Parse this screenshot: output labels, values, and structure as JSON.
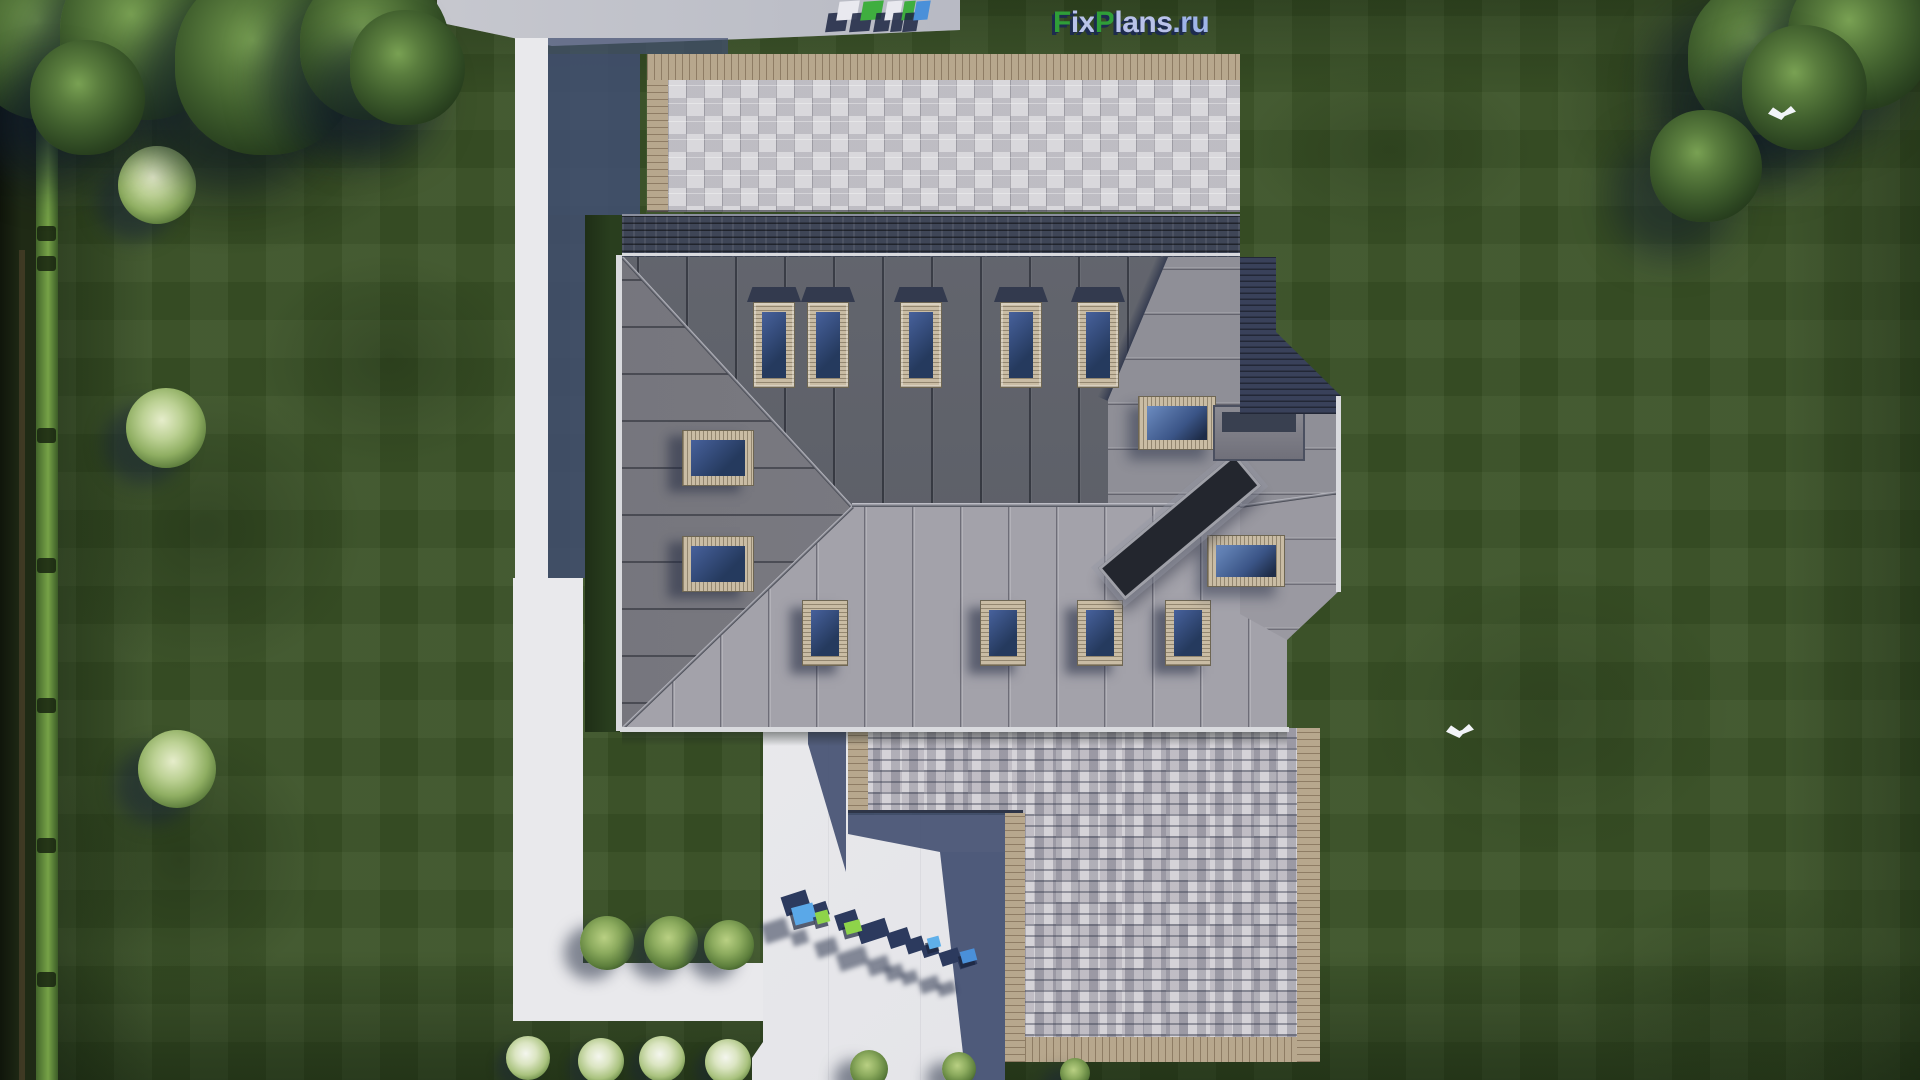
{
  "watermark": {
    "site_logo": {
      "f": "F",
      "ix": "ix",
      "p": "P",
      "lans": "lans",
      "ru": ".ru",
      "full_text": "FixPlans.ru"
    },
    "pavement_text": "FixPlans.ru"
  },
  "scene": {
    "type": "aerial top-down 3D render of house plan",
    "house": {
      "main_roof": "standing-seam metal hip roof",
      "skylight_count_north": 5,
      "skylight_count_south": 4,
      "skylight_count_west": 2,
      "skylight_count_east": 2,
      "features": [
        "paved patio wing (top)",
        "shingled garage wing (bottom)",
        "roof channel with chimney",
        "white driveway",
        "L-shaped walkway"
      ]
    },
    "environment": [
      "lawn with mowing stripes",
      "hedge and fence on left",
      "tree clusters top-left and top-right",
      "light green bushes",
      "white flower bushes",
      "two white birds"
    ]
  },
  "palette": {
    "lawn": "#3a5226",
    "roof_north": "#5d6069",
    "roof_south": "#a3a2aa",
    "roof_west": "#7e7e86",
    "roof_east": "#8f8f97",
    "skylight_frame": "#c9bca4",
    "logo_green": "#2f9e38",
    "logo_lavender": "#b9c2ea",
    "logo_shadow": "#1d2b4e"
  },
  "layout_items": {
    "lawn_blotches": [
      {
        "x": 30,
        "y": 40,
        "w": 400,
        "h": 220,
        "o": "0.5"
      },
      {
        "x": 40,
        "y": 380,
        "w": 330,
        "h": 300,
        "o": "0.35"
      },
      {
        "x": 30,
        "y": 720,
        "w": 300,
        "h": 280,
        "o": "0.38"
      },
      {
        "x": 250,
        "y": 250,
        "w": 280,
        "h": 220,
        "o": "0.3"
      },
      {
        "x": 1540,
        "y": 10,
        "w": 320,
        "h": 200,
        "o": "0.4"
      },
      {
        "x": 1360,
        "y": 560,
        "w": 380,
        "h": 300,
        "o": "0.2"
      },
      {
        "x": 1560,
        "y": 880,
        "w": 360,
        "h": 220,
        "o": "0.25"
      },
      {
        "x": 1240,
        "y": 60,
        "w": 300,
        "h": 180,
        "o": "0.22"
      }
    ],
    "hedge_posts": [
      {
        "y": 102
      },
      {
        "y": 226
      },
      {
        "y": 256
      },
      {
        "y": 428
      },
      {
        "y": 558
      },
      {
        "y": 698
      },
      {
        "y": 838
      },
      {
        "y": 972
      }
    ],
    "trees": [
      {
        "x": -30,
        "y": -40,
        "d": 160
      },
      {
        "x": 60,
        "y": -50,
        "d": 170
      },
      {
        "x": 175,
        "y": -30,
        "d": 185
      },
      {
        "x": 300,
        "y": -30,
        "d": 150
      },
      {
        "x": 350,
        "y": 10,
        "d": 115
      },
      {
        "x": 30,
        "y": 40,
        "d": 115
      },
      {
        "x": 1688,
        "y": -20,
        "d": 155
      },
      {
        "x": 1788,
        "y": -35,
        "d": 145
      },
      {
        "x": 1742,
        "y": 25,
        "d": 125
      },
      {
        "x": 1650,
        "y": 110,
        "d": 112
      }
    ],
    "light_bushes": [
      {
        "x": 118,
        "y": 146,
        "d": 78
      },
      {
        "x": 126,
        "y": 388,
        "d": 80
      },
      {
        "x": 138,
        "y": 730,
        "d": 78
      }
    ],
    "corner_bushes": [
      {
        "x": 580,
        "y": 916,
        "d": 54
      },
      {
        "x": 644,
        "y": 916,
        "d": 54
      },
      {
        "x": 704,
        "y": 920,
        "d": 50
      }
    ],
    "wing_bushes": [
      {
        "x": 850,
        "y": 1050,
        "d": 38
      },
      {
        "x": 942,
        "y": 1052,
        "d": 34
      },
      {
        "x": 1060,
        "y": 1058,
        "d": 30
      }
    ],
    "flower_bushes": [
      {
        "x": 506,
        "y": 1036,
        "d": 44
      },
      {
        "x": 578,
        "y": 1038,
        "d": 46
      },
      {
        "x": 639,
        "y": 1036,
        "d": 46
      },
      {
        "x": 705,
        "y": 1039,
        "d": 46
      }
    ],
    "skylights_north": [
      {
        "x": 753
      },
      {
        "x": 807
      },
      {
        "x": 900
      },
      {
        "x": 1000
      },
      {
        "x": 1077
      }
    ],
    "skylights_south": [
      {
        "x": 802
      },
      {
        "x": 980
      },
      {
        "x": 1077
      },
      {
        "x": 1165
      }
    ],
    "skylights_west": [
      {
        "x": 682,
        "y": 430
      },
      {
        "x": 682,
        "y": 536
      }
    ],
    "skylights_east": [
      {
        "x": 1138,
        "y": 396,
        "w": 76,
        "h": 52
      },
      {
        "x": 1207,
        "y": 535,
        "w": 76,
        "h": 50
      }
    ],
    "sidewalk_letters": [
      {
        "x": 838,
        "w": 20,
        "c": "#e9e9ef"
      },
      {
        "x": 862,
        "w": 20,
        "c": "#3fae3f"
      },
      {
        "x": 886,
        "w": 15,
        "c": "#e9e9ef"
      },
      {
        "x": 903,
        "w": 11,
        "c": "#3fae3f"
      },
      {
        "x": 915,
        "w": 14,
        "c": "#4a90d9"
      }
    ],
    "wm_blocks": [
      {
        "x": 783,
        "y": 893,
        "w": 26,
        "h": 20
      },
      {
        "x": 812,
        "y": 903,
        "w": 16,
        "h": 14
      },
      {
        "x": 836,
        "y": 912,
        "w": 22,
        "h": 16
      },
      {
        "x": 858,
        "y": 922,
        "w": 30,
        "h": 18
      },
      {
        "x": 888,
        "y": 930,
        "w": 22,
        "h": 16
      },
      {
        "x": 906,
        "y": 938,
        "w": 18,
        "h": 14
      },
      {
        "x": 922,
        "y": 944,
        "w": 16,
        "h": 12
      },
      {
        "x": 940,
        "y": 950,
        "w": 20,
        "h": 14
      },
      {
        "x": 958,
        "y": 955,
        "w": 18,
        "h": 12
      }
    ],
    "wm_cubes": [
      {
        "x": 793,
        "y": 905,
        "w": 22,
        "h": 18,
        "c": "#5aa8e8"
      },
      {
        "x": 816,
        "y": 911,
        "w": 13,
        "h": 12,
        "c": "#8ed44a"
      },
      {
        "x": 845,
        "y": 921,
        "w": 16,
        "h": 12,
        "c": "#8ed44a"
      },
      {
        "x": 928,
        "y": 937,
        "w": 12,
        "h": 11,
        "c": "#5fb0ea"
      },
      {
        "x": 961,
        "y": 950,
        "w": 15,
        "h": 12,
        "c": "#4a90d9"
      }
    ],
    "birds": [
      {
        "x": 1446,
        "y": 724
      },
      {
        "x": 1768,
        "y": 106
      }
    ]
  }
}
